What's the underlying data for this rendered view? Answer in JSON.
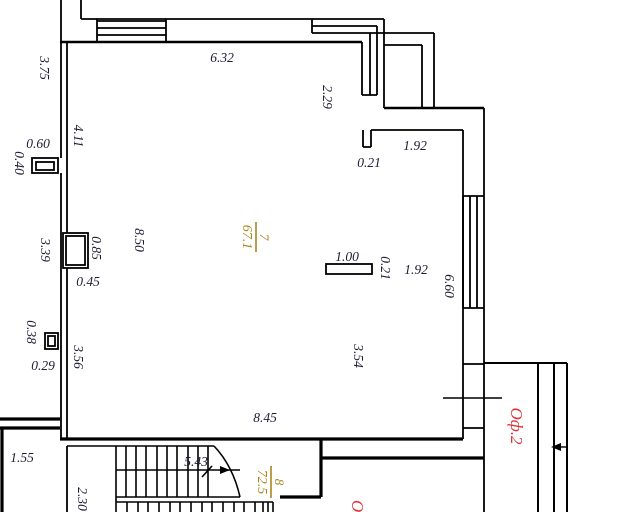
{
  "plan": {
    "type": "floor-plan",
    "colors": {
      "wall": "#000000",
      "dimension_text": "#1c1c35",
      "room_label": "#a8861e",
      "office_label": "#e03238",
      "background": "#ffffff"
    },
    "dimensions": [
      {
        "text": "3.75",
        "orientation": "vertical"
      },
      {
        "text": "6.32",
        "orientation": "horizontal"
      },
      {
        "text": "2.29",
        "orientation": "vertical"
      },
      {
        "text": "1.92",
        "orientation": "horizontal"
      },
      {
        "text": "0.21",
        "orientation": "horizontal"
      },
      {
        "text": "4.11",
        "orientation": "vertical"
      },
      {
        "text": "0.60",
        "orientation": "horizontal"
      },
      {
        "text": "0.40",
        "orientation": "vertical"
      },
      {
        "text": "8.50",
        "orientation": "vertical"
      },
      {
        "text": "1.00",
        "orientation": "horizontal"
      },
      {
        "text": "0.21",
        "orientation": "vertical"
      },
      {
        "text": "1.92",
        "orientation": "horizontal"
      },
      {
        "text": "6.60",
        "orientation": "vertical"
      },
      {
        "text": "3.39",
        "orientation": "vertical"
      },
      {
        "text": "0.85",
        "orientation": "vertical"
      },
      {
        "text": "0.45",
        "orientation": "horizontal"
      },
      {
        "text": "0.38",
        "orientation": "vertical"
      },
      {
        "text": "0.29",
        "orientation": "horizontal"
      },
      {
        "text": "3.56",
        "orientation": "vertical"
      },
      {
        "text": "3.54",
        "orientation": "vertical"
      },
      {
        "text": "8.45",
        "orientation": "horizontal"
      },
      {
        "text": "1.55",
        "orientation": "horizontal"
      },
      {
        "text": "5.43",
        "orientation": "horizontal"
      },
      {
        "text": "2.30",
        "orientation": "vertical"
      }
    ],
    "rooms": [
      {
        "number": "7",
        "area": "67.1"
      },
      {
        "number": "8",
        "area": "72.5"
      }
    ],
    "offices": [
      {
        "text": "Оф.2"
      },
      {
        "text": "Оф"
      }
    ]
  }
}
